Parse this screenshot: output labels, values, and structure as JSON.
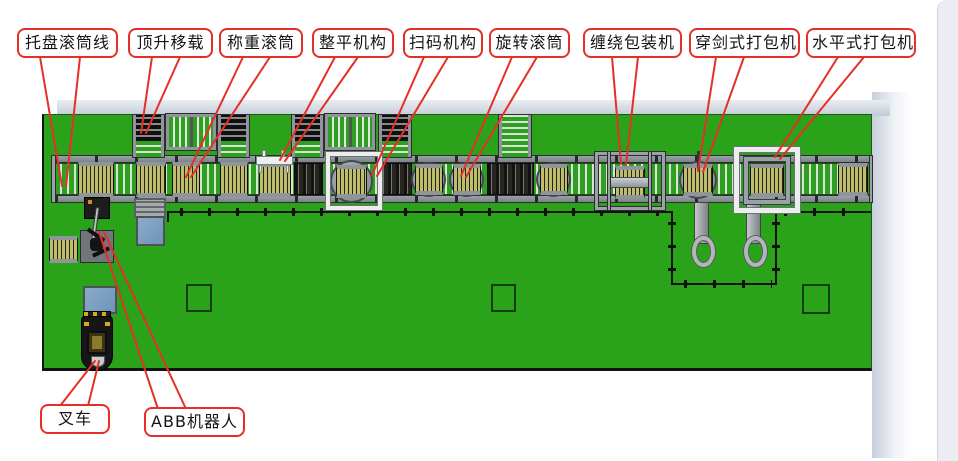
{
  "diagram_title": "pallet conveying and packing line layout",
  "callouts": [
    {
      "id": "pallet-roller-line",
      "label": "托盘滚筒线"
    },
    {
      "id": "lift-transfer",
      "label": "顶升移载"
    },
    {
      "id": "weighing-roller",
      "label": "称重滚筒"
    },
    {
      "id": "leveling-mechanism",
      "label": "整平机构"
    },
    {
      "id": "scanner-mechanism",
      "label": "扫码机构"
    },
    {
      "id": "rotary-roller",
      "label": "旋转滚筒"
    },
    {
      "id": "wrapping-machine",
      "label": "缠绕包装机"
    },
    {
      "id": "sword-strapper",
      "label": "穿剑式打包机"
    },
    {
      "id": "horizontal-strapper",
      "label": "水平式打包机"
    },
    {
      "id": "forklift",
      "label": "叉车"
    },
    {
      "id": "abb-robot",
      "label": "ABB机器人"
    }
  ],
  "colors": {
    "floor_green": "#2aa31a",
    "callout_red": "#e43026",
    "pallet_khaki": "#bdbd6d",
    "machine_gray": "#8e959b",
    "circle_gray": "#9aa1a6",
    "pallet_blue": "#7fa2c4",
    "fence_black": "#111111"
  }
}
